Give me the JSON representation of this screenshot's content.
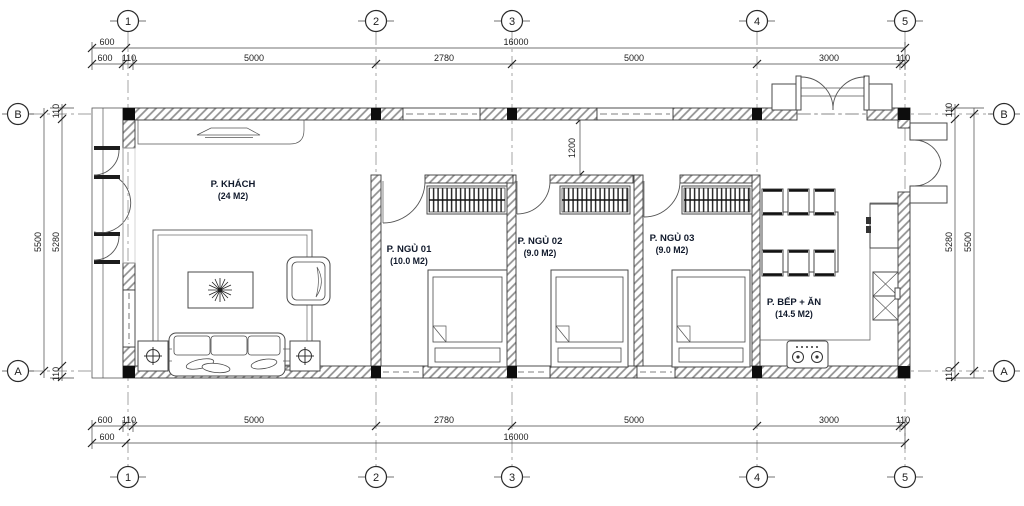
{
  "drawing": {
    "grid": {
      "cols": [
        "1",
        "2",
        "3",
        "4",
        "5"
      ],
      "rows": [
        "B",
        "A"
      ]
    },
    "dims": {
      "overall": [
        "600",
        "16000"
      ],
      "segments": [
        "600",
        "110",
        "5000",
        "2780",
        "5000",
        "3000",
        "110"
      ],
      "side_outer": "5500",
      "side_inner": "5280",
      "side_end": "110",
      "passage": "1200"
    },
    "rooms": [
      {
        "name": "P. KHÁCH",
        "area": "(24 M2)"
      },
      {
        "name": "P. NGỦ 01",
        "area": "(10.0 M2)"
      },
      {
        "name": "P. NGỦ 02",
        "area": "(9.0 M2)"
      },
      {
        "name": "P. NGỦ 03",
        "area": "(9.0 M2)"
      },
      {
        "name": "P. BẾP + ĂN",
        "area": "(14.5 M2)"
      }
    ],
    "colors": {
      "line": "#3a3a3a",
      "label": "#10192b",
      "column": "#0d0d0d"
    }
  }
}
